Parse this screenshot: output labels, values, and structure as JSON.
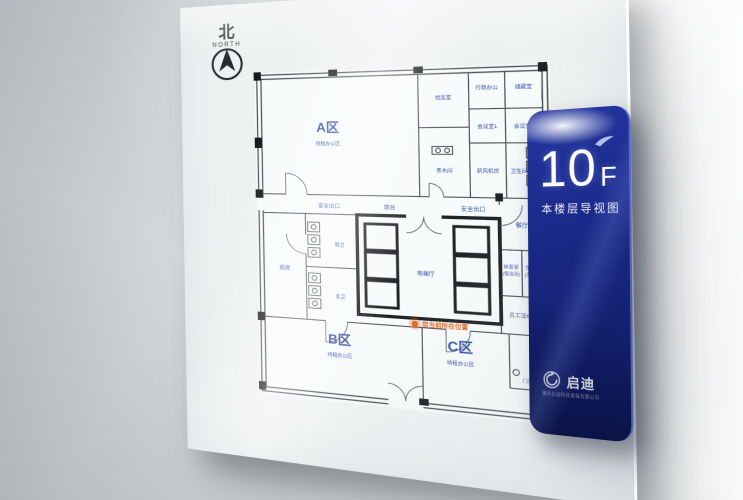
{
  "compass": {
    "north_cn": "北",
    "north_en": "NORTH"
  },
  "board": {
    "zones": [
      {
        "id": "A",
        "label": "A区",
        "sub": "待租办公区"
      },
      {
        "id": "B",
        "label": "B区",
        "sub": "待租办公区"
      },
      {
        "id": "C",
        "label": "C区",
        "sub": "待租办公区"
      }
    ],
    "rooms": {
      "archive": "档案室",
      "admin_office": "行政办公",
      "storage": "储藏室",
      "meeting1": "会议室1",
      "meeting2": "会议室2",
      "fresh_air": "新风机房",
      "restroom_ne": "卫生间",
      "tea_room": "茶水间",
      "dining": "餐厅",
      "lounge": "休息室",
      "lounge_sub": "(保洁间)",
      "duty": "值班室",
      "duty_sub": "(开水间)",
      "activity": "员工活动区",
      "machine_room": "机房",
      "male_wc": "男卫",
      "female_wc": "女卫",
      "reception": "前台",
      "elevator_hall": "电梯厅",
      "access": "门禁处",
      "exit_left": "安全出口",
      "exit_right": "安全出口"
    },
    "location_marker": {
      "label": "您当前所在位置",
      "color": "#e2641c"
    },
    "label_color": "#2a4aa4",
    "wall_color": "#4b5054"
  },
  "panel": {
    "floor_number": "10",
    "floor_letter": "F",
    "subtitle": "本楼层导视图",
    "brand_name": "启迪",
    "brand_tagline": "重庆启迪科技发展有限公司",
    "bg_top": "#2336a0",
    "bg_bottom": "#0e1954"
  }
}
